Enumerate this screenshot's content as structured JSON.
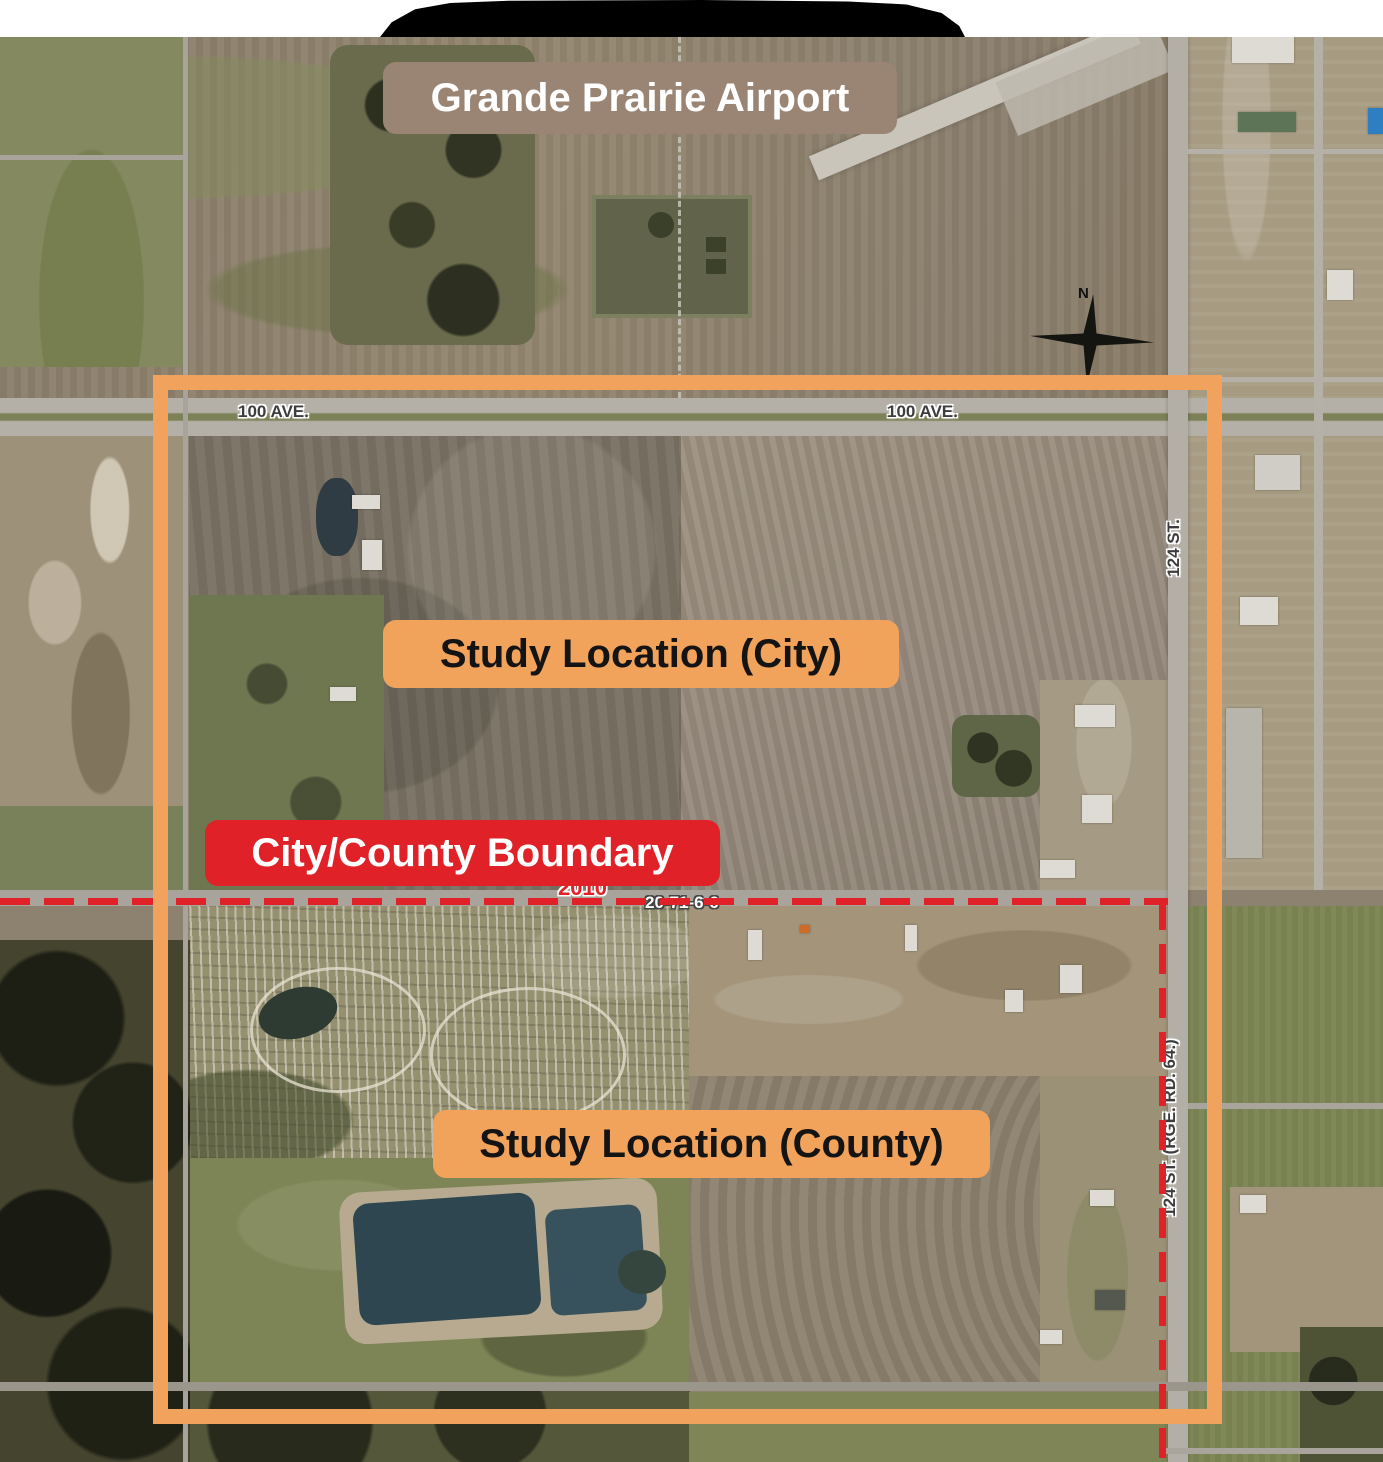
{
  "map": {
    "region_labels": {
      "airport": "Grande Prairie Airport",
      "study_city": "Study Location (City)",
      "boundary": "City/County Boundary",
      "study_county": "Study Location (County)"
    },
    "road_labels": {
      "ave100_west": "100 AVE.",
      "ave100_east": "100 AVE.",
      "st124": "124 ST.",
      "st124_rge": "124 ST. (RGE. RD. 64.)"
    },
    "annotations": {
      "year": "2010",
      "section_id": "20-71-6-6",
      "north": "N"
    },
    "colors": {
      "study_outline_orange": "#F1A35E",
      "boundary_red": "#E02127",
      "airport_label_brown": "#9A8575",
      "study_label_orange": "#F1A25B"
    }
  }
}
